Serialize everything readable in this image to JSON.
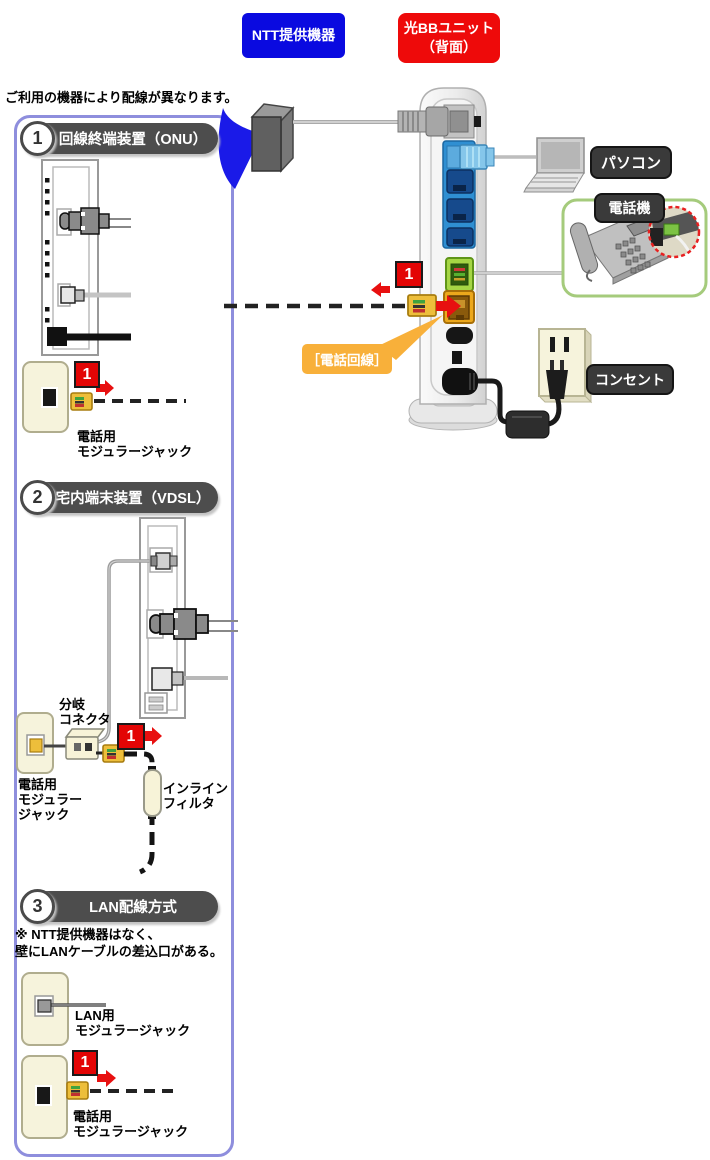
{
  "header": {
    "ntt": "NTT提供機器",
    "bb1": "光BBユニット",
    "bb2": "（背面）"
  },
  "intro": "ご利用の機器により配線が異なります。",
  "sections": {
    "s1": {
      "num": "1",
      "title": "回線終端装置（ONU）",
      "step": "1",
      "jack1": "電話用",
      "jack2": "モジュラージャック"
    },
    "s2": {
      "num": "2",
      "title": "宅内端末装置（VDSL）",
      "step": "1",
      "branch1": "分岐",
      "branch2": "コネクタ",
      "jack1": "電話用",
      "jack2": "モジュラー",
      "jack3": "ジャック",
      "filter1": "インライン",
      "filter2": "フィルタ"
    },
    "s3": {
      "num": "3",
      "title": "LAN配線方式",
      "step": "1",
      "note1": "※ NTT提供機器はなく、",
      "note2": "壁にLANケーブルの差込口がある。",
      "lan1": "LAN用",
      "lan2": "モジュラージャック",
      "jack1": "電話用",
      "jack2": "モジュラージャック"
    }
  },
  "diagram": {
    "step": "1",
    "pc": "パソコン",
    "phone": "電話機",
    "outlet": "コンセント",
    "phone_line": "［電話回線］"
  },
  "colors": {
    "ntt_blue": "#0a0ae0",
    "bb_red": "#ee0a0a",
    "panel_border": "#8e8edd",
    "header_pill": "#4d4d4d",
    "marker_red": "#e30505",
    "connector_yellow": "#edbe3b",
    "lan_panel_blue": "#2f8fd2",
    "tel_port_green": "#a6d645",
    "line_port_orange": "#eca81c",
    "callout_orange": "#f8b03a",
    "phone_box_green": "#a5cb7c",
    "label_pill_dark": "#3a3a3a"
  }
}
